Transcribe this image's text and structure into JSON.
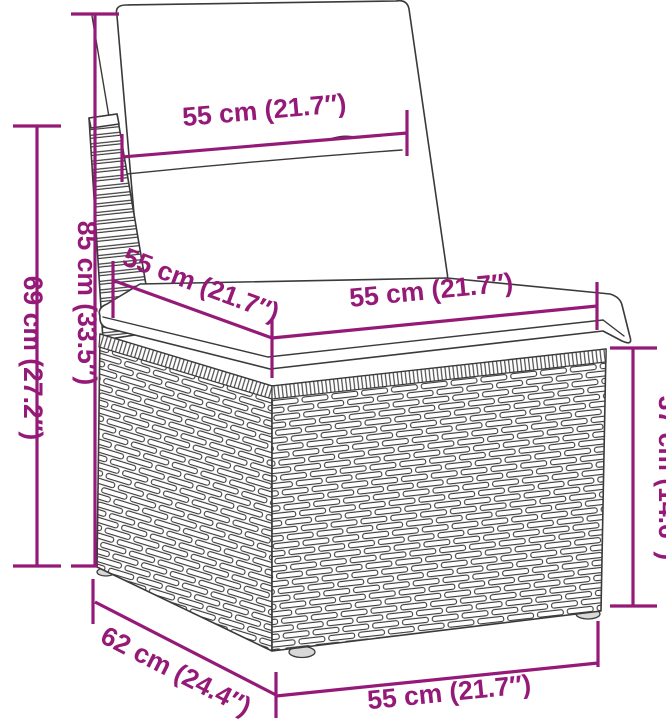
{
  "diagram": {
    "subject": "poly-rattan-garden-sofa-section-with-cushions",
    "style": {
      "dimension_color": "#951A78",
      "outline_color": "#3a3a3a",
      "background_color": "#ffffff"
    },
    "dimensions": {
      "back_cushion_width": {
        "label": "55 cm (21.7″)"
      },
      "total_height": {
        "label": "85 cm (33.5″)"
      },
      "frame_height": {
        "label": "69 cm (27.2″)"
      },
      "seat_depth": {
        "label": "55 cm (21.7″)"
      },
      "seat_width": {
        "label": "55 cm (21.7″)"
      },
      "base_height": {
        "label": "37 cm (14.6″)"
      },
      "base_depth": {
        "label": "62 cm (24.4″)"
      },
      "base_width": {
        "label": "55 cm (21.7″)"
      }
    }
  }
}
